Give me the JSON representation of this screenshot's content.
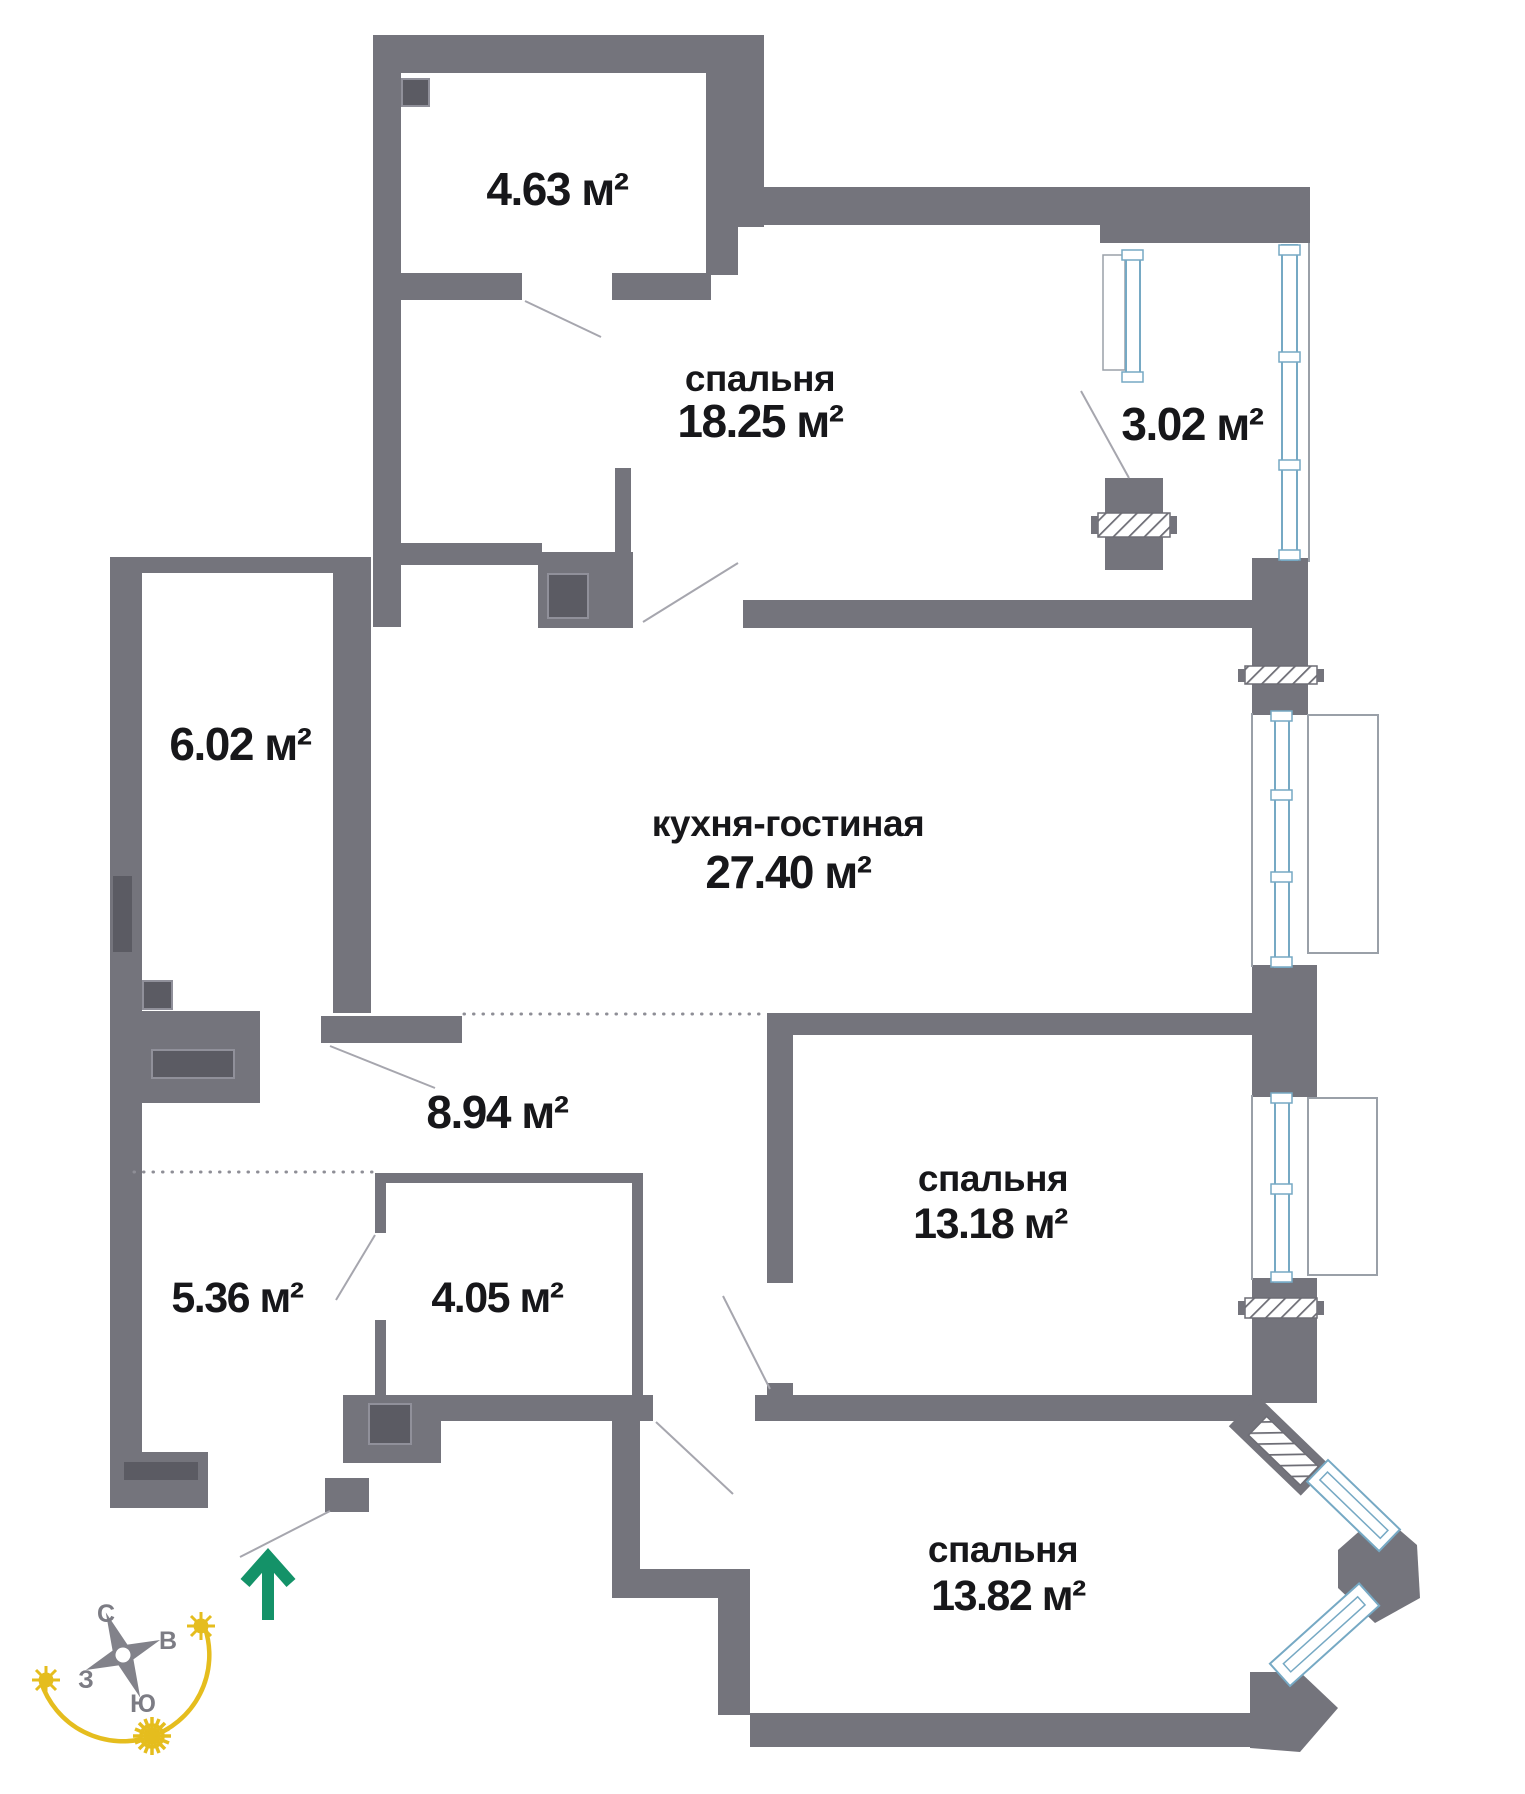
{
  "plan": {
    "rooms": {
      "storage": {
        "area": "4.63 м²"
      },
      "bedroom_top": {
        "name": "спальня",
        "area": "18.25 м²"
      },
      "balcony": {
        "area": "3.02 м²"
      },
      "dressing": {
        "area": "6.02 м²"
      },
      "kitchen_living": {
        "name": "кухня-гостиная",
        "area": "27.40 м²"
      },
      "hallway": {
        "area": "8.94 м²"
      },
      "hall": {
        "area": "5.36 м²"
      },
      "bathroom": {
        "area": "4.05 м²"
      },
      "bedroom_right": {
        "name": "спальня",
        "area": "13.18 м²"
      },
      "bedroom_bottom": {
        "name": "спальня",
        "area": "13.82 м²"
      }
    },
    "compass": {
      "north": "С",
      "east": "В",
      "west": "З",
      "south": "Ю"
    },
    "colors": {
      "wall": "#74747c",
      "vent": "#5b5b63",
      "window_frame": "#76a9c4",
      "sun_yellow": "#e5bd1e",
      "entrance_green": "#149268",
      "text": "#17171a"
    }
  }
}
